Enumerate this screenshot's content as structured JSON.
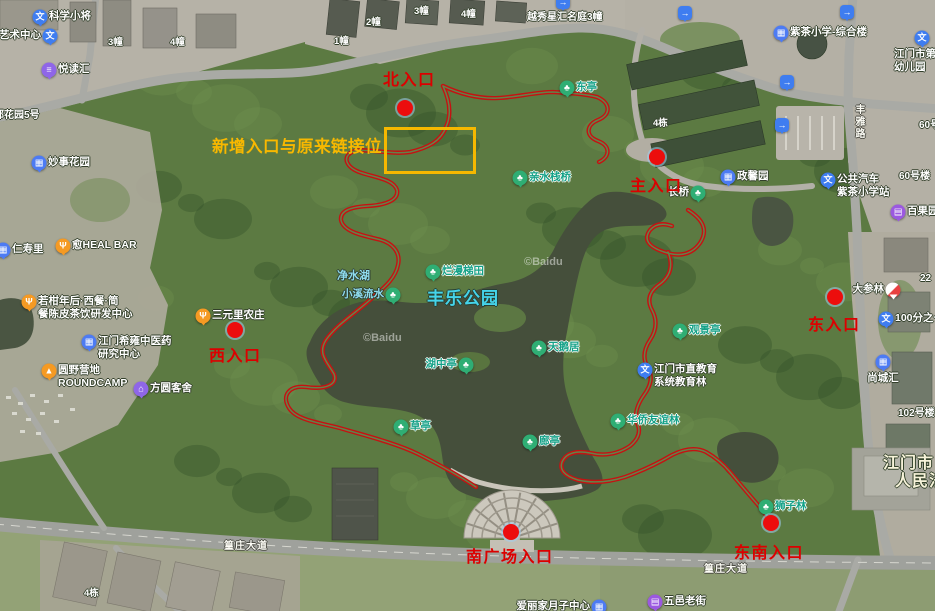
{
  "attribution": "©Baidu",
  "park": {
    "name": "丰乐公园"
  },
  "note": {
    "text": "新增入口与原来链接位",
    "box": {
      "x": 384,
      "y": 127,
      "w": 86,
      "h": 41
    }
  },
  "entrances": [
    {
      "label": "北入口",
      "dot_x": 405,
      "dot_y": 108,
      "text_x": 383,
      "text_y": 66
    },
    {
      "label": "主入口",
      "dot_x": 657,
      "dot_y": 157,
      "text_x": 630,
      "text_y": 172
    },
    {
      "label": "东入口",
      "dot_x": 835,
      "dot_y": 297,
      "text_x": 808,
      "text_y": 311
    },
    {
      "label": "西入口",
      "dot_x": 235,
      "dot_y": 330,
      "text_x": 209,
      "text_y": 342
    },
    {
      "label": "南广场入口",
      "dot_x": 511,
      "dot_y": 532,
      "text_x": 466,
      "text_y": 543
    },
    {
      "label": "东南入口",
      "dot_x": 771,
      "dot_y": 523,
      "text_x": 734,
      "text_y": 539
    }
  ],
  "poi_markers": [
    {
      "name": "kexuexiaojiang",
      "icon": "edu",
      "x": 40,
      "y": 17,
      "side": "right",
      "style": "white",
      "labels": [
        "科学小将"
      ]
    },
    {
      "name": "yishuzhongxin",
      "icon": "edu",
      "x": 50,
      "y": 36,
      "side": "left",
      "style": "white",
      "labels": [
        "艺术中心"
      ]
    },
    {
      "name": "yueduhui",
      "icon": "book",
      "x": 49,
      "y": 70,
      "side": "right",
      "style": "white",
      "labels": [
        "悦读汇"
      ]
    },
    {
      "name": "miaoshihuayuan",
      "icon": "biz",
      "x": 39,
      "y": 163,
      "side": "right",
      "style": "white",
      "labels": [
        "妙事花园"
      ]
    },
    {
      "name": "renshouli",
      "icon": "biz",
      "x": 3,
      "y": 250,
      "side": "right",
      "style": "white",
      "labels": [
        "仁寿里"
      ]
    },
    {
      "name": "heal-bar",
      "icon": "food",
      "x": 63,
      "y": 246,
      "side": "right",
      "style": "white",
      "labels": [
        "愈HEAL BAR"
      ]
    },
    {
      "name": "ruogannian",
      "icon": "food",
      "x": 29,
      "y": 302,
      "side": "right",
      "style": "white",
      "labels": [
        "若柑年后·西餐·简",
        "餐陈皮茶饮研发中心"
      ]
    },
    {
      "name": "zhongyiyao",
      "icon": "biz",
      "x": 89,
      "y": 342,
      "side": "right",
      "style": "white",
      "labels": [
        "江门希雍中医药",
        "研究中心"
      ]
    },
    {
      "name": "roundcamp",
      "icon": "camp",
      "x": 49,
      "y": 371,
      "side": "right",
      "style": "white",
      "labels": [
        "圆野营地",
        "ROUNDCAMP"
      ]
    },
    {
      "name": "fangyuankeshe",
      "icon": "hotel",
      "x": 141,
      "y": 389,
      "side": "right",
      "style": "white",
      "labels": [
        "方圆客舍"
      ]
    },
    {
      "name": "sanyuanli",
      "icon": "food",
      "x": 203,
      "y": 316,
      "side": "right",
      "style": "white",
      "labels": [
        "三元里农庄"
      ]
    },
    {
      "name": "xiaoxiliushui",
      "icon": "tree",
      "x": 393,
      "y": 295,
      "side": "left",
      "style": "cyan",
      "labels": [
        "小溪流水"
      ]
    },
    {
      "name": "lanmantitian",
      "icon": "tree",
      "x": 433,
      "y": 272,
      "side": "right",
      "style": "green",
      "labels": [
        "烂漫梯田"
      ]
    },
    {
      "name": "huzhongting",
      "icon": "tree",
      "x": 466,
      "y": 365,
      "side": "left",
      "style": "green",
      "labels": [
        "湖中亭"
      ]
    },
    {
      "name": "tianeju",
      "icon": "tree",
      "x": 539,
      "y": 348,
      "side": "right",
      "style": "green",
      "labels": [
        "天鹅居"
      ]
    },
    {
      "name": "dongting",
      "icon": "tree",
      "x": 567,
      "y": 88,
      "side": "right",
      "style": "green",
      "labels": [
        "东亭"
      ]
    },
    {
      "name": "qinshuizhanqiao",
      "icon": "tree",
      "x": 520,
      "y": 178,
      "side": "right",
      "style": "green",
      "labels": [
        "亲水栈桥"
      ]
    },
    {
      "name": "changqiao",
      "icon": "tree",
      "x": 698,
      "y": 193,
      "side": "left",
      "style": "white",
      "labels": [
        "长桥"
      ]
    },
    {
      "name": "guanjingting",
      "icon": "tree",
      "x": 680,
      "y": 331,
      "side": "right",
      "style": "green",
      "labels": [
        "观景亭"
      ]
    },
    {
      "name": "jiaoyulin",
      "icon": "edu",
      "x": 645,
      "y": 370,
      "side": "right",
      "style": "white",
      "labels": [
        "江门市直教育",
        "系统教育林"
      ]
    },
    {
      "name": "huaqiaoyouyilin",
      "icon": "tree",
      "x": 618,
      "y": 421,
      "side": "right",
      "style": "green",
      "labels": [
        "华侨友谊林"
      ]
    },
    {
      "name": "caoting",
      "icon": "tree",
      "x": 401,
      "y": 427,
      "side": "right",
      "style": "green",
      "labels": [
        "草亭"
      ]
    },
    {
      "name": "langting",
      "icon": "tree",
      "x": 530,
      "y": 442,
      "side": "right",
      "style": "green",
      "labels": [
        "廊亭"
      ]
    },
    {
      "name": "shizilin",
      "icon": "tree",
      "x": 766,
      "y": 507,
      "side": "right",
      "style": "green",
      "labels": [
        "狮子林"
      ]
    },
    {
      "name": "zicha-school",
      "icon": "school",
      "x": 781,
      "y": 33,
      "side": "right",
      "style": "white",
      "labels": [
        "紫茶小学-综合楼"
      ]
    },
    {
      "name": "youeryuan",
      "icon": "edu",
      "x": 922,
      "y": 38,
      "side": "belowleft",
      "style": "white",
      "labels": [
        "江门市第",
        "幼儿园"
      ]
    },
    {
      "name": "bus-stop",
      "icon": "edu",
      "x": 828,
      "y": 180,
      "side": "right",
      "style": "white",
      "labels": [
        "公共汽车",
        "紫茶小学站"
      ]
    },
    {
      "name": "zhengxinyuan",
      "icon": "biz",
      "x": 728,
      "y": 177,
      "side": "right",
      "style": "white",
      "labels": [
        "政馨园"
      ]
    },
    {
      "name": "baiguoyuan",
      "icon": "shop",
      "x": 898,
      "y": 212,
      "side": "right",
      "style": "white",
      "labels": [
        "百果园"
      ]
    },
    {
      "name": "dashenlin",
      "icon": "pharm",
      "x": 893,
      "y": 290,
      "side": "left",
      "style": "white",
      "labels": [
        "大参林"
      ]
    },
    {
      "name": "100fenzhiyi",
      "icon": "edu",
      "x": 886,
      "y": 319,
      "side": "right",
      "style": "white",
      "labels": [
        "100分之一"
      ]
    },
    {
      "name": "shangchenghui",
      "icon": "biz",
      "x": 883,
      "y": 362,
      "side": "below",
      "style": "white",
      "labels": [
        "尚城汇"
      ]
    },
    {
      "name": "wuyilaojie",
      "icon": "shop",
      "x": 655,
      "y": 602,
      "side": "right",
      "style": "white",
      "labels": [
        "五邑老街"
      ]
    },
    {
      "name": "ailijia",
      "icon": "biz",
      "x": 599,
      "y": 607,
      "side": "left",
      "style": "white",
      "labels": [
        "爱丽家月子中心"
      ]
    }
  ],
  "exit_icons": [
    {
      "x": 563,
      "y": 2
    },
    {
      "x": 685,
      "y": 13
    },
    {
      "x": 847,
      "y": 12
    },
    {
      "x": 787,
      "y": 82
    },
    {
      "x": 782,
      "y": 125
    }
  ],
  "text_labels": [
    {
      "name": "jingshuihu",
      "text": "净水湖",
      "x": 337,
      "y": 270,
      "style": "cyan",
      "size": 11
    },
    {
      "name": "park-name",
      "text": "丰乐公园",
      "x": 427,
      "y": 289,
      "style": "park"
    },
    {
      "name": "bldg-1zhuang",
      "text": "1幢",
      "x": 334,
      "y": 36,
      "style": "white",
      "size": 9.5
    },
    {
      "name": "bldg-2zhuang",
      "text": "2幢",
      "x": 366,
      "y": 17,
      "style": "white",
      "size": 9.5
    },
    {
      "name": "bldg-3zhuang",
      "text": "3幢",
      "x": 414,
      "y": 6,
      "style": "white",
      "size": 9.5
    },
    {
      "name": "bldg-4zhuang",
      "text": "4幢",
      "x": 461,
      "y": 9,
      "style": "white",
      "size": 9.5
    },
    {
      "name": "bldg-3zhuang-w",
      "text": "3幢",
      "x": 108,
      "y": 37,
      "style": "white",
      "size": 9.5
    },
    {
      "name": "bldg-4zhuang-w",
      "text": "4幢",
      "x": 170,
      "y": 37,
      "style": "white",
      "size": 9.5
    },
    {
      "name": "yuexiu-xinghui",
      "text": "越秀星汇名庭3幢",
      "x": 527,
      "y": 12,
      "style": "white",
      "size": 10
    },
    {
      "name": "bldg-4dong",
      "text": "4栋",
      "x": 653,
      "y": 118,
      "style": "white",
      "size": 9.5
    },
    {
      "name": "bldg-4dong-s",
      "text": "4栋",
      "x": 84,
      "y": 588,
      "style": "white",
      "size": 9.5
    },
    {
      "name": "bldg-60hao",
      "text": "60号楼",
      "x": 899,
      "y": 171,
      "style": "white",
      "size": 10
    },
    {
      "name": "bldg-60hao-b",
      "text": "60号楼",
      "x": 919,
      "y": 120,
      "style": "white",
      "size": 10
    },
    {
      "name": "bldg-22",
      "text": "22",
      "x": 920,
      "y": 273,
      "style": "white",
      "size": 10
    },
    {
      "name": "bldg-102hao",
      "text": "102号楼",
      "x": 898,
      "y": 408,
      "style": "white",
      "size": 10
    },
    {
      "name": "yuhuayuan5",
      "text": "郁花园5号",
      "x": -6,
      "y": 110,
      "style": "white",
      "size": 10
    },
    {
      "name": "road-huangzhuang-w",
      "text": "篁庄大道",
      "x": 224,
      "y": 541,
      "style": "road"
    },
    {
      "name": "road-huangzhuang-e",
      "text": "篁庄大道",
      "x": 704,
      "y": 564,
      "style": "road"
    },
    {
      "name": "road-fengyalu",
      "text": "丰雅路",
      "x": 852,
      "y": 104,
      "style": "road",
      "vertical": true
    },
    {
      "name": "court-line1",
      "text": "江门市",
      "x": 883,
      "y": 454,
      "style": "cream"
    },
    {
      "name": "court-line2",
      "text": "人民法院",
      "x": 895,
      "y": 472,
      "style": "cream"
    }
  ],
  "watermarks": [
    {
      "x": 524,
      "y": 256
    },
    {
      "x": 363,
      "y": 332
    }
  ]
}
